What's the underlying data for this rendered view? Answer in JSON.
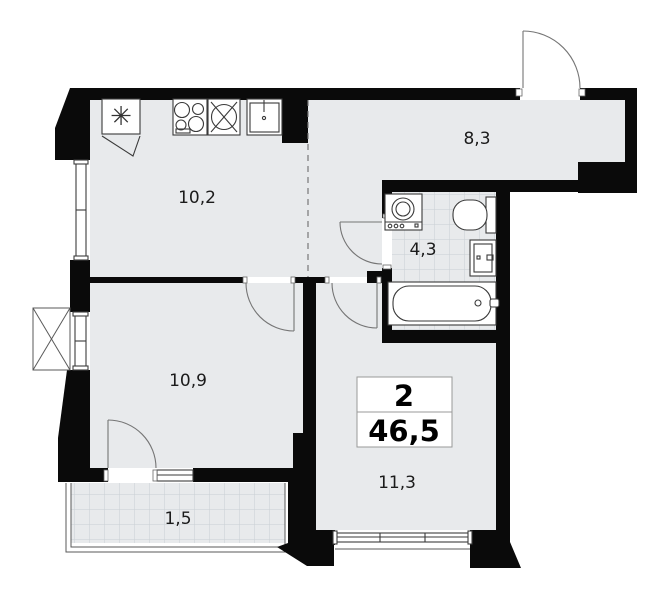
{
  "plan_header": {
    "rooms_count": "2",
    "total_area": "46,5"
  },
  "rooms": {
    "kitchen": {
      "area": "10,2"
    },
    "hallway": {
      "area": "8,3"
    },
    "bathroom": {
      "area": "4,3"
    },
    "bedroom": {
      "area": "10,9"
    },
    "living_room": {
      "area": "11,3"
    },
    "balcony": {
      "area": "1,5"
    }
  },
  "fixtures": {
    "kitchen": [
      "fridge",
      "stove",
      "round-sink",
      "washbasin"
    ],
    "bathroom": [
      "washing-machine",
      "toilet",
      "washbasin",
      "bathtub"
    ],
    "exterior": [
      "air-conditioner-basket"
    ]
  },
  "colors": {
    "wall": "#0a0a0a",
    "floor": "#e8eaec",
    "tile_line": "#c9cfd3",
    "fixture_stroke": "#3a3a3a",
    "door_arc": "#757575",
    "label_text": "#1b1b1b"
  }
}
